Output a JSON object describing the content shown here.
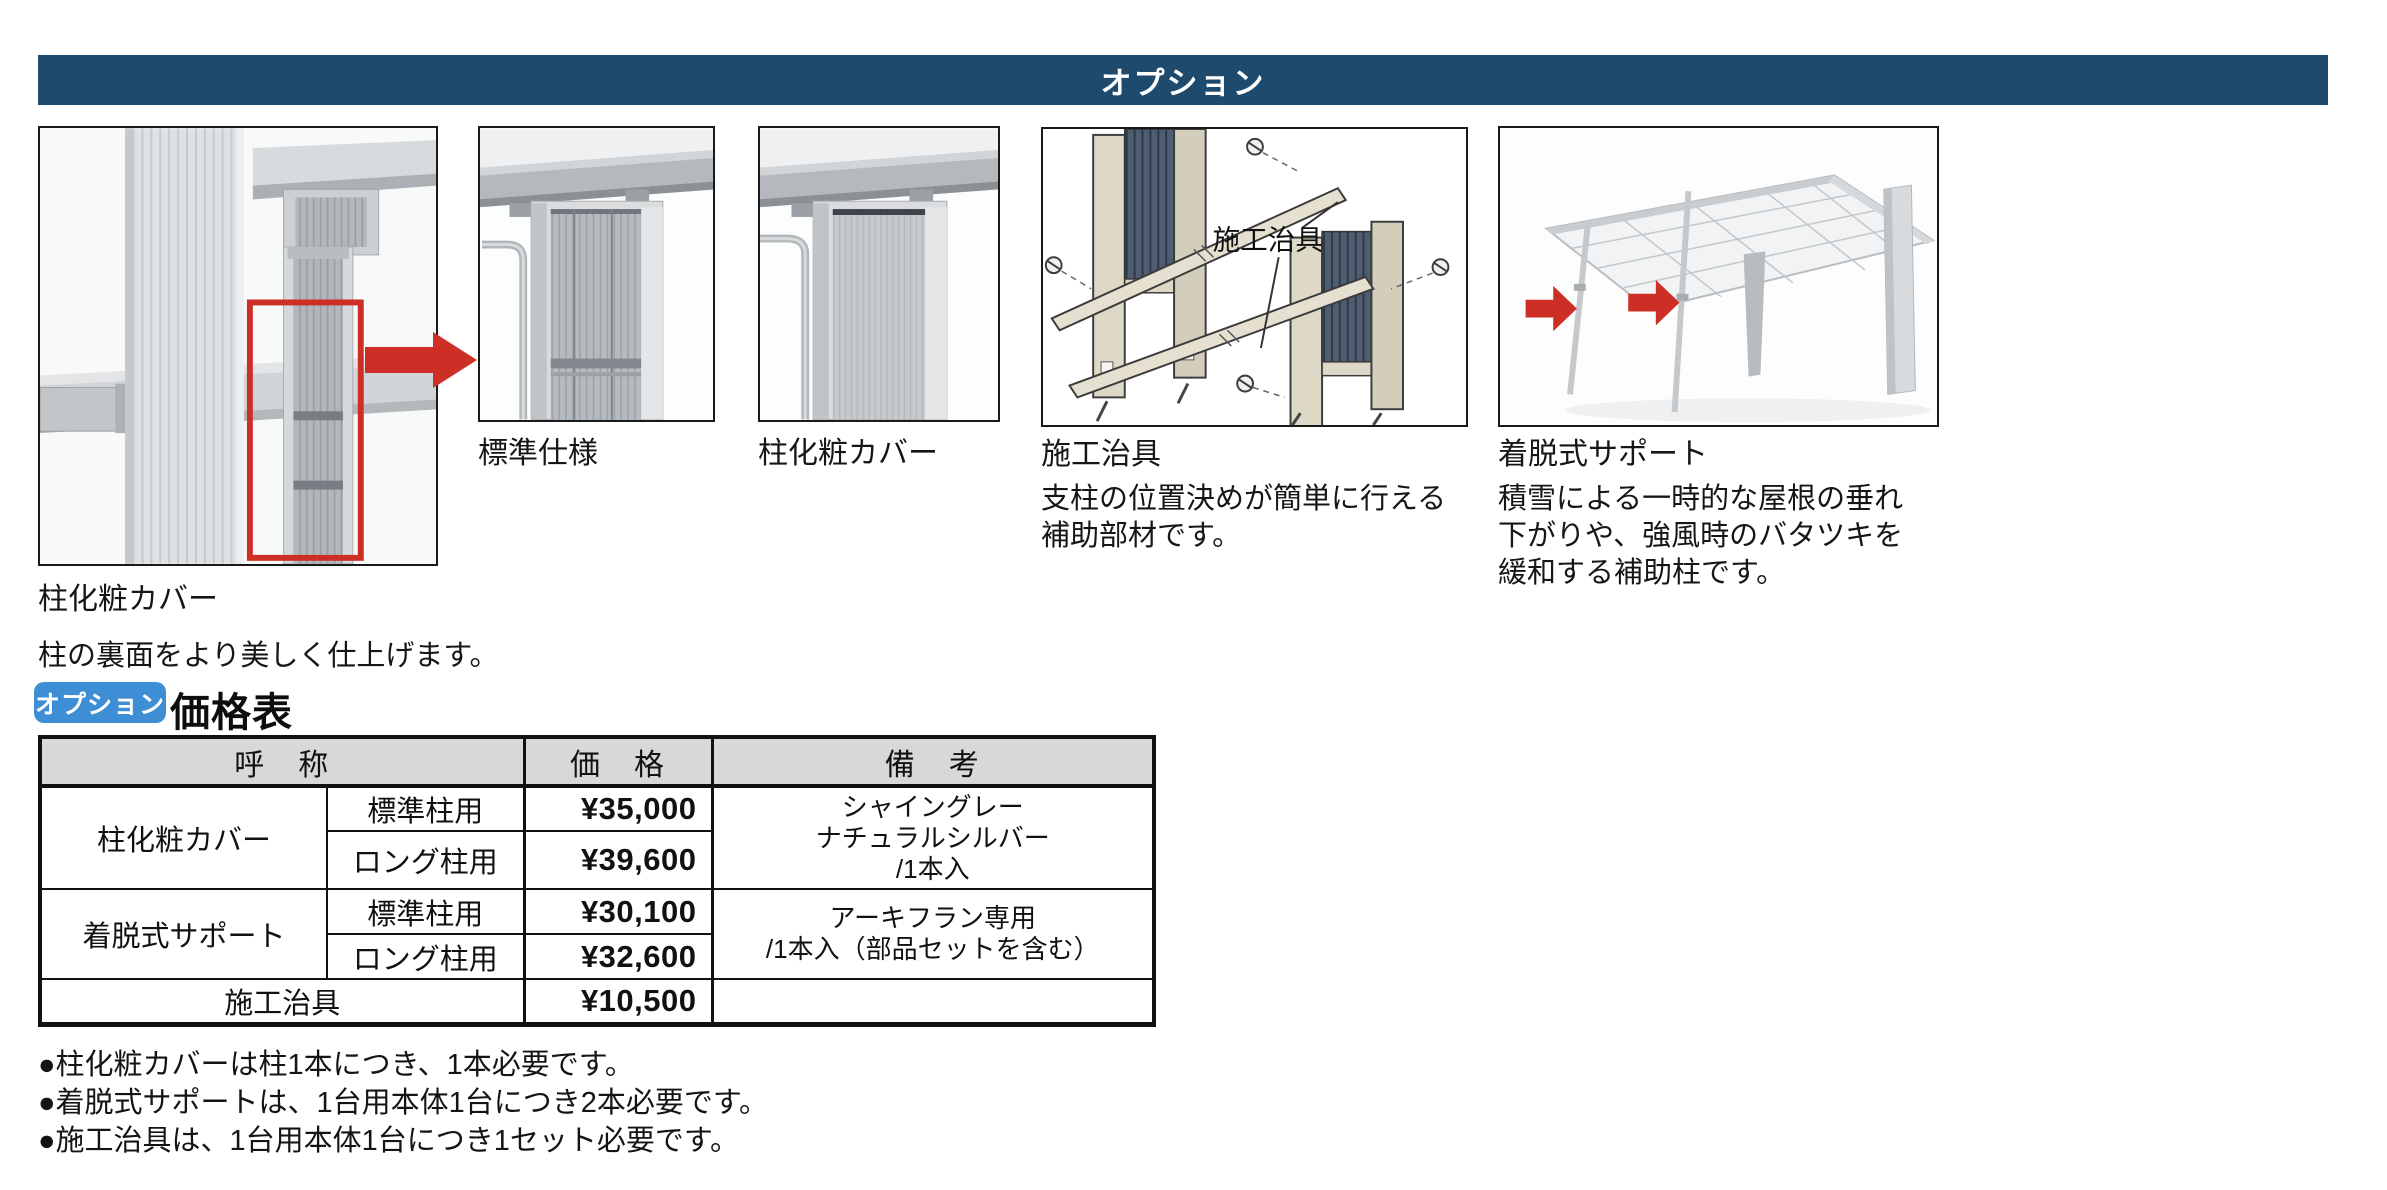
{
  "header": {
    "title": "オプション"
  },
  "figures": {
    "main": {
      "caption": "柱化粧カバー",
      "description": "柱の裏面をより美しく仕上げます。"
    },
    "standard": {
      "caption": "標準仕様"
    },
    "cover": {
      "caption": "柱化粧カバー"
    },
    "jig": {
      "caption": "施工治具",
      "diagram_label": "施工治具",
      "description_lines": [
        "支柱の位置決めが簡単に行える",
        "補助部材です。"
      ]
    },
    "support": {
      "caption": "着脱式サポート",
      "description_lines": [
        "積雪による一時的な屋根の垂れ",
        "下がりや、強風時のバタツキを",
        "緩和する補助柱です。"
      ]
    }
  },
  "price_section": {
    "badge": "オプション",
    "title": "価格表",
    "table": {
      "headers": {
        "name": "呼　称",
        "price": "価　格",
        "remarks": "備　考"
      },
      "groups": [
        {
          "name": "柱化粧カバー",
          "variants": [
            {
              "label": "標準柱用",
              "price": "¥35,000"
            },
            {
              "label": "ロング柱用",
              "price": "¥39,600"
            }
          ],
          "remarks_lines": [
            "シャイングレー",
            "ナチュラルシルバー",
            "/1本入"
          ]
        },
        {
          "name": "着脱式サポート",
          "variants": [
            {
              "label": "標準柱用",
              "price": "¥30,100"
            },
            {
              "label": "ロング柱用",
              "price": "¥32,600"
            }
          ],
          "remarks_lines": [
            "アーキフラン専用",
            "/1本入（部品セットを含む）"
          ]
        },
        {
          "name": "施工治具",
          "variants": [
            {
              "label": "",
              "price": "¥10,500"
            }
          ],
          "remarks_lines": []
        }
      ]
    }
  },
  "footnotes": [
    "●柱化粧カバーは柱1本につき、1本必要です。",
    "●着脱式サポートは、1台用本体1台につき2本必要です。",
    "●施工治具は、1台用本体1台につき1セット必要です。"
  ],
  "colors": {
    "header_bar": "#1e4a6d",
    "badge_blue": "#3e8ed6",
    "accent_red": "#cd2f26",
    "table_header_bg": "#d8d8d8",
    "text": "#111111"
  }
}
